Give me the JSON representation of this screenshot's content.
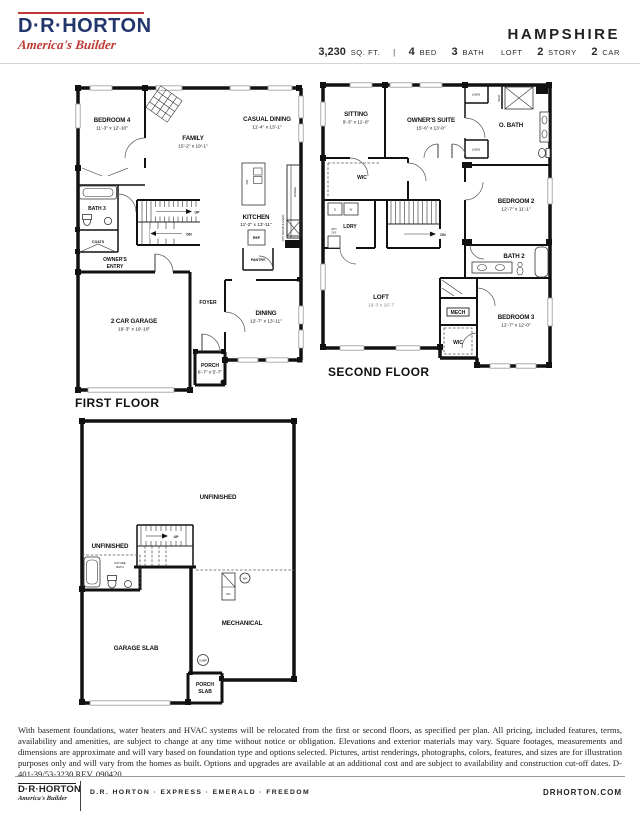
{
  "header": {
    "brand": "D·R·HORTON",
    "tagline": "America's Builder",
    "plan_name": "HAMPSHIRE",
    "sqft_value": "3,230",
    "sqft_unit": "SQ. FT.",
    "separator": "|",
    "bed_num": "4",
    "bed_label": "BED",
    "bath_num": "3",
    "bath_label": "BATH",
    "loft_label": "LOFT",
    "story_num": "2",
    "story_label": "STORY",
    "car_num": "2",
    "car_label": "CAR"
  },
  "first_floor": {
    "title": "FIRST FLOOR",
    "bedroom4_name": "BEDROOM 4",
    "bedroom4_dim": "11'-3\" x 12'-10\"",
    "family_name": "FAMILY",
    "family_dim": "15'-2\" x 19'-1\"",
    "casual_dining_name": "CASUAL DINING",
    "casual_dining_dim": "11'-4\" x 13'-1\"",
    "bath3": "BATH 3",
    "coats": "COATS",
    "owners_entry_line1": "OWNER'S",
    "owners_entry_line2": "ENTRY",
    "kitchen_name": "KITCHEN",
    "kitchen_dim": "11'-2\" x 13'-11\"",
    "pantry": "PANTRY",
    "ref": "REF",
    "dw": "DW",
    "range": "RANGE",
    "opt_double_oven": "OPT DOUBLE OVEN",
    "garage_name": "2 CAR GARAGE",
    "garage_dim": "19'-3\" x 19'-10\"",
    "foyer": "FOYER",
    "dining_name": "DINING",
    "dining_dim": "12'-7\" x 13'-11\"",
    "porch_name": "PORCH",
    "porch_dim": "6'-7\" x 5'-7\"",
    "up": "UP",
    "dn": "DN"
  },
  "second_floor": {
    "title": "SECOND FLOOR",
    "sitting_name": "SITTING",
    "sitting_dim": "9'-3\" x 11'-0\"",
    "owners_suite_name": "OWNER'S SUITE",
    "owners_suite_dim": "15'-6\" x 13'-0\"",
    "obath": "O. BATH",
    "linen_top": "LINEN",
    "linen_mid": "LINEN",
    "seat": "SEAT",
    "wic_owner": "WIC",
    "ldry": "LDRY",
    "washer": "W",
    "dryer": "D",
    "opt_ds_line1": "OPT",
    "opt_ds_line2": "D/S",
    "bedroom2_name": "BEDROOM 2",
    "bedroom2_dim": "12'-7\" x 11'-1\"",
    "bath2": "BATH 2",
    "loft_name": "LOFT",
    "loft_dim": "19'-3 x 16'-7",
    "mech": "MECH",
    "wic_bottom": "WIC",
    "bedroom3_name": "BEDROOM 3",
    "bedroom3_dim": "12'-7\" x 12'-0\"",
    "dn": "DN"
  },
  "basement": {
    "unfinished_main": "UNFINISHED",
    "unfinished_left": "UNFINISHED",
    "future_bath_line1": "FUTURE",
    "future_bath_line2": "BATH",
    "garage_slab": "GARAGE SLAB",
    "mechanical": "MECHANICAL",
    "porch_slab_line1": "PORCH",
    "porch_slab_line2": "SLAB",
    "sump": "SUMP",
    "wh": "WH",
    "dg": "DG",
    "up": "UP"
  },
  "disclaimer": "With basement foundations, water heaters and HVAC systems will be relocated from the first or second floors, as specified per plan. All pricing, included features, terms, availability and amenities, are subject to change at any time without notice or obligation. Elevations and exterior materials may vary. Square footages, measurements and dimensions are approximate and will vary based on foundation type and options selected. Pictures, artist renderings, photographs, colors, features, and sizes are for illustration purposes only and will vary from the homes as built. Options and upgrades are available at an additional cost and are subject to availability and construction cut-off dates.  D-401-39/53-3230    REV. 090420",
  "footer": {
    "brand": "D·R·HORTON",
    "tagline": "America's Builder",
    "brands_line": "D.R. HORTON · EXPRESS · EMERALD · FREEDOM",
    "website": "DRHORTON.COM"
  },
  "colors": {
    "navy": "#23366b",
    "red": "#bf3a33",
    "ink": "#111111"
  }
}
